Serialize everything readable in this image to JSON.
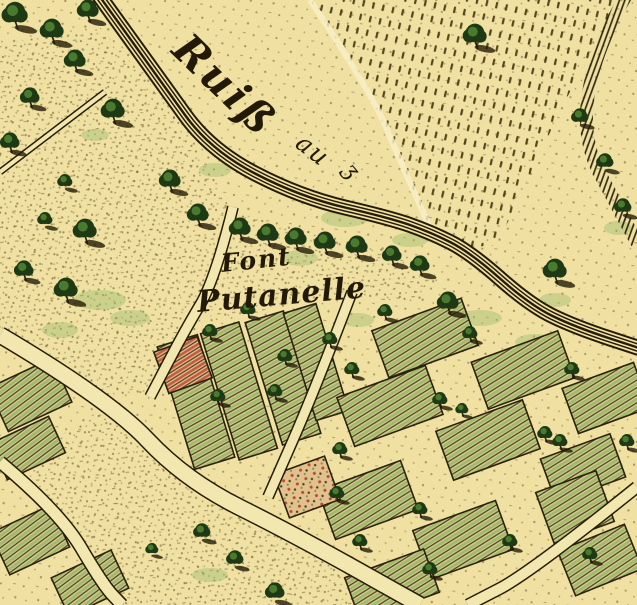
{
  "map": {
    "description": "antique engraved town-plan map with hand colouring, cream paper, garden plots and stream",
    "labels": {
      "stream": {
        "main": "Ruiß",
        "secondary": "au",
        "flourish": "ʒ"
      },
      "place": {
        "line1": "Font",
        "line2": "Putanelle"
      }
    },
    "palette": {
      "paper": "#f0e0a2",
      "road": "#f3e7b0",
      "ink": "#241c06",
      "ink_soft": "#5f5224",
      "green_light": "#96b566",
      "green_mid": "#4a7a2e",
      "green_dark": "#1d3a14",
      "red": "#b8442c",
      "plot_underlay": "#d8cf8f",
      "red_underlay": "#e2c18e",
      "highlight": "#f9f0c8"
    },
    "stream": {
      "pts": [
        [
          95,
          -10
        ],
        [
          160,
          80
        ],
        [
          210,
          150
        ],
        [
          300,
          197
        ],
        [
          390,
          218
        ],
        [
          430,
          232
        ],
        [
          470,
          252
        ],
        [
          530,
          305
        ],
        [
          575,
          327
        ],
        [
          645,
          350
        ]
      ]
    },
    "roads": [
      {
        "name": "main-road",
        "pts": [
          [
            0,
            335
          ],
          [
            110,
            400
          ],
          [
            185,
            480
          ],
          [
            295,
            535
          ],
          [
            420,
            605
          ]
        ],
        "w": 15
      },
      {
        "name": "riverside-road",
        "pts": [
          [
            233,
            207
          ],
          [
            215,
            280
          ],
          [
            185,
            330
          ],
          [
            150,
            397
          ]
        ],
        "w": 9
      },
      {
        "name": "lower-left-road",
        "pts": [
          [
            0,
            462
          ],
          [
            60,
            512
          ],
          [
            103,
            585
          ],
          [
            122,
            605
          ]
        ],
        "w": 11
      },
      {
        "name": "center-road",
        "pts": [
          [
            352,
            292
          ],
          [
            315,
            390
          ],
          [
            268,
            497
          ]
        ],
        "w": 9
      },
      {
        "name": "southeast-road",
        "pts": [
          [
            637,
            487
          ],
          [
            530,
            573
          ],
          [
            468,
            605
          ]
        ],
        "w": 10
      },
      {
        "name": "field-path",
        "pts": [
          [
            0,
            172
          ],
          [
            105,
            92
          ]
        ],
        "w": 4
      }
    ],
    "field": {
      "poly": [
        [
          310,
          0
        ],
        [
          620,
          0
        ],
        [
          563,
          105
        ],
        [
          497,
          245
        ],
        [
          460,
          248
        ],
        [
          430,
          228
        ],
        [
          400,
          160
        ],
        [
          370,
          90
        ]
      ],
      "west_edge": [
        [
          310,
          0
        ],
        [
          370,
          90
        ],
        [
          400,
          160
        ],
        [
          430,
          228
        ]
      ]
    },
    "hedge": {
      "pts": [
        [
          627,
          -6
        ],
        [
          563,
          105
        ],
        [
          637,
          243
        ]
      ],
      "w": 13
    },
    "meadows": [
      {
        "name": "left-meadow",
        "pts": [
          [
            98,
            25
          ],
          [
            160,
            95
          ],
          [
            205,
            160
          ],
          [
            228,
            205
          ],
          [
            213,
            280
          ],
          [
            183,
            330
          ],
          [
            148,
            395
          ],
          [
            105,
            397
          ],
          [
            0,
            332
          ],
          [
            0,
            45
          ]
        ]
      },
      {
        "name": "south-meadow",
        "pts": [
          [
            120,
            605
          ],
          [
            10,
            468
          ],
          [
            108,
            405
          ],
          [
            190,
            485
          ],
          [
            300,
            540
          ],
          [
            418,
            605
          ]
        ]
      },
      {
        "name": "font-meadow",
        "pts": [
          [
            233,
            212
          ],
          [
            420,
            258
          ],
          [
            440,
            275
          ],
          [
            420,
            300
          ],
          [
            302,
            300
          ],
          [
            210,
            325
          ],
          [
            215,
            268
          ]
        ]
      }
    ],
    "plots": [
      {
        "cx": 30,
        "cy": 395,
        "w": 70,
        "h": 48,
        "rot": -25,
        "fill": "green"
      },
      {
        "cx": 28,
        "cy": 448,
        "w": 64,
        "h": 40,
        "rot": -25,
        "fill": "green"
      },
      {
        "cx": 30,
        "cy": 540,
        "w": 66,
        "h": 46,
        "rot": -25,
        "fill": "green"
      },
      {
        "cx": 90,
        "cy": 583,
        "w": 66,
        "h": 42,
        "rot": -25,
        "fill": "green"
      },
      {
        "cx": 196,
        "cy": 402,
        "w": 42,
        "h": 128,
        "rot": -17,
        "fill": "green"
      },
      {
        "cx": 239,
        "cy": 391,
        "w": 40,
        "h": 132,
        "rot": -17,
        "fill": "green"
      },
      {
        "cx": 283,
        "cy": 378,
        "w": 40,
        "h": 128,
        "rot": -17,
        "fill": "green"
      },
      {
        "cx": 316,
        "cy": 362,
        "w": 34,
        "h": 112,
        "rot": -17,
        "fill": "green"
      },
      {
        "cx": 183,
        "cy": 365,
        "w": 46,
        "h": 44,
        "rot": -20,
        "fill": "redhatch"
      },
      {
        "cx": 425,
        "cy": 338,
        "w": 95,
        "h": 50,
        "rot": -20,
        "fill": "green"
      },
      {
        "cx": 523,
        "cy": 370,
        "w": 92,
        "h": 50,
        "rot": -20,
        "fill": "green"
      },
      {
        "cx": 606,
        "cy": 398,
        "w": 76,
        "h": 48,
        "rot": -20,
        "fill": "green"
      },
      {
        "cx": 390,
        "cy": 406,
        "w": 94,
        "h": 52,
        "rot": -20,
        "fill": "green"
      },
      {
        "cx": 488,
        "cy": 440,
        "w": 92,
        "h": 52,
        "rot": -20,
        "fill": "green"
      },
      {
        "cx": 583,
        "cy": 468,
        "w": 74,
        "h": 46,
        "rot": -20,
        "fill": "green"
      },
      {
        "cx": 368,
        "cy": 500,
        "w": 88,
        "h": 52,
        "rot": -20,
        "fill": "green"
      },
      {
        "cx": 463,
        "cy": 540,
        "w": 88,
        "h": 52,
        "rot": -20,
        "fill": "green"
      },
      {
        "cx": 575,
        "cy": 507,
        "w": 64,
        "h": 54,
        "rot": -20,
        "fill": "green"
      },
      {
        "cx": 392,
        "cy": 585,
        "w": 84,
        "h": 46,
        "rot": -20,
        "fill": "green"
      },
      {
        "cx": 600,
        "cy": 560,
        "w": 72,
        "h": 48,
        "rot": -22,
        "fill": "green"
      },
      {
        "cx": 307,
        "cy": 487,
        "w": 54,
        "h": 46,
        "rot": -20,
        "fill": "reddots"
      }
    ],
    "trees": [
      [
        15,
        12,
        12,
        0
      ],
      [
        52,
        28,
        11,
        0
      ],
      [
        88,
        8,
        10,
        0
      ],
      [
        75,
        58,
        10,
        0
      ],
      [
        30,
        95,
        9,
        0
      ],
      [
        10,
        140,
        9,
        0
      ],
      [
        113,
        108,
        11,
        0
      ],
      [
        170,
        178,
        10,
        0
      ],
      [
        198,
        212,
        10,
        0
      ],
      [
        65,
        180,
        7,
        1
      ],
      [
        85,
        228,
        11,
        0
      ],
      [
        45,
        218,
        7,
        1
      ],
      [
        66,
        287,
        11,
        0
      ],
      [
        24,
        268,
        9,
        0
      ],
      [
        240,
        226,
        10,
        0
      ],
      [
        268,
        232,
        10,
        0
      ],
      [
        296,
        236,
        10,
        0
      ],
      [
        325,
        240,
        10,
        0
      ],
      [
        357,
        244,
        10,
        0
      ],
      [
        392,
        253,
        9,
        0
      ],
      [
        420,
        263,
        9,
        0
      ],
      [
        448,
        300,
        10,
        0
      ],
      [
        555,
        268,
        11,
        0
      ],
      [
        475,
        33,
        11,
        0
      ],
      [
        580,
        115,
        8,
        1
      ],
      [
        605,
        160,
        8,
        1
      ],
      [
        623,
        205,
        8,
        1
      ],
      [
        210,
        330,
        7,
        0
      ],
      [
        285,
        355,
        7,
        0
      ],
      [
        330,
        338,
        7,
        0
      ],
      [
        218,
        395,
        7,
        0
      ],
      [
        275,
        390,
        7,
        0
      ],
      [
        248,
        308,
        7,
        0
      ],
      [
        385,
        310,
        7,
        0
      ],
      [
        470,
        332,
        7,
        0
      ],
      [
        572,
        368,
        7,
        0
      ],
      [
        352,
        368,
        7,
        0
      ],
      [
        440,
        398,
        7,
        0
      ],
      [
        545,
        432,
        7,
        0
      ],
      [
        340,
        448,
        7,
        0
      ],
      [
        560,
        440,
        7,
        0
      ],
      [
        337,
        492,
        7,
        0
      ],
      [
        420,
        508,
        7,
        0
      ],
      [
        510,
        540,
        7,
        0
      ],
      [
        590,
        553,
        7,
        0
      ],
      [
        360,
        540,
        7,
        0
      ],
      [
        430,
        568,
        7,
        0
      ],
      [
        627,
        440,
        7,
        0
      ],
      [
        462,
        408,
        6,
        0
      ],
      [
        202,
        530,
        8,
        1
      ],
      [
        235,
        557,
        8,
        1
      ],
      [
        275,
        590,
        9,
        1
      ],
      [
        152,
        548,
        6,
        1
      ]
    ],
    "green_patches": [
      [
        100,
        300,
        26,
        10
      ],
      [
        130,
        318,
        20,
        8
      ],
      [
        345,
        218,
        24,
        9
      ],
      [
        300,
        258,
        18,
        8
      ],
      [
        480,
        318,
        22,
        8
      ],
      [
        535,
        342,
        20,
        8
      ],
      [
        358,
        320,
        16,
        7
      ],
      [
        618,
        228,
        14,
        7
      ],
      [
        60,
        330,
        18,
        8
      ],
      [
        210,
        575,
        18,
        7
      ],
      [
        215,
        170,
        16,
        7
      ],
      [
        410,
        240,
        18,
        7
      ],
      [
        95,
        135,
        14,
        6
      ],
      [
        555,
        300,
        16,
        7
      ]
    ]
  }
}
